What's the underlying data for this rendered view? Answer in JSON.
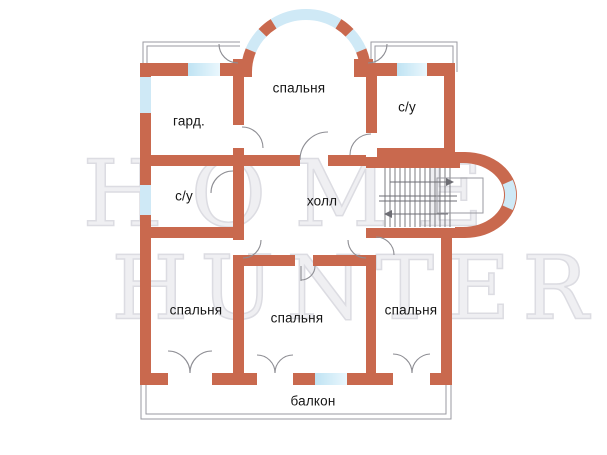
{
  "watermark": {
    "line1": "HOME",
    "line2": "HUNTER"
  },
  "rooms": {
    "wardrobe": {
      "label": "гард."
    },
    "bedroom_top": {
      "label": "спальня"
    },
    "bathroom_top_right": {
      "label": "с/у"
    },
    "bathroom_left": {
      "label": "с/у"
    },
    "hall": {
      "label": "холл"
    },
    "bedroom_bottom_left": {
      "label": "спальня"
    },
    "bedroom_bottom_middle": {
      "label": "спальня"
    },
    "bedroom_bottom_right": {
      "label": "спальня"
    },
    "balcony": {
      "label": "балкон"
    }
  },
  "colors": {
    "wall": "#c9694e",
    "window": "#cfe9f6",
    "outline": "#9a9aa0",
    "label": "#161616"
  }
}
